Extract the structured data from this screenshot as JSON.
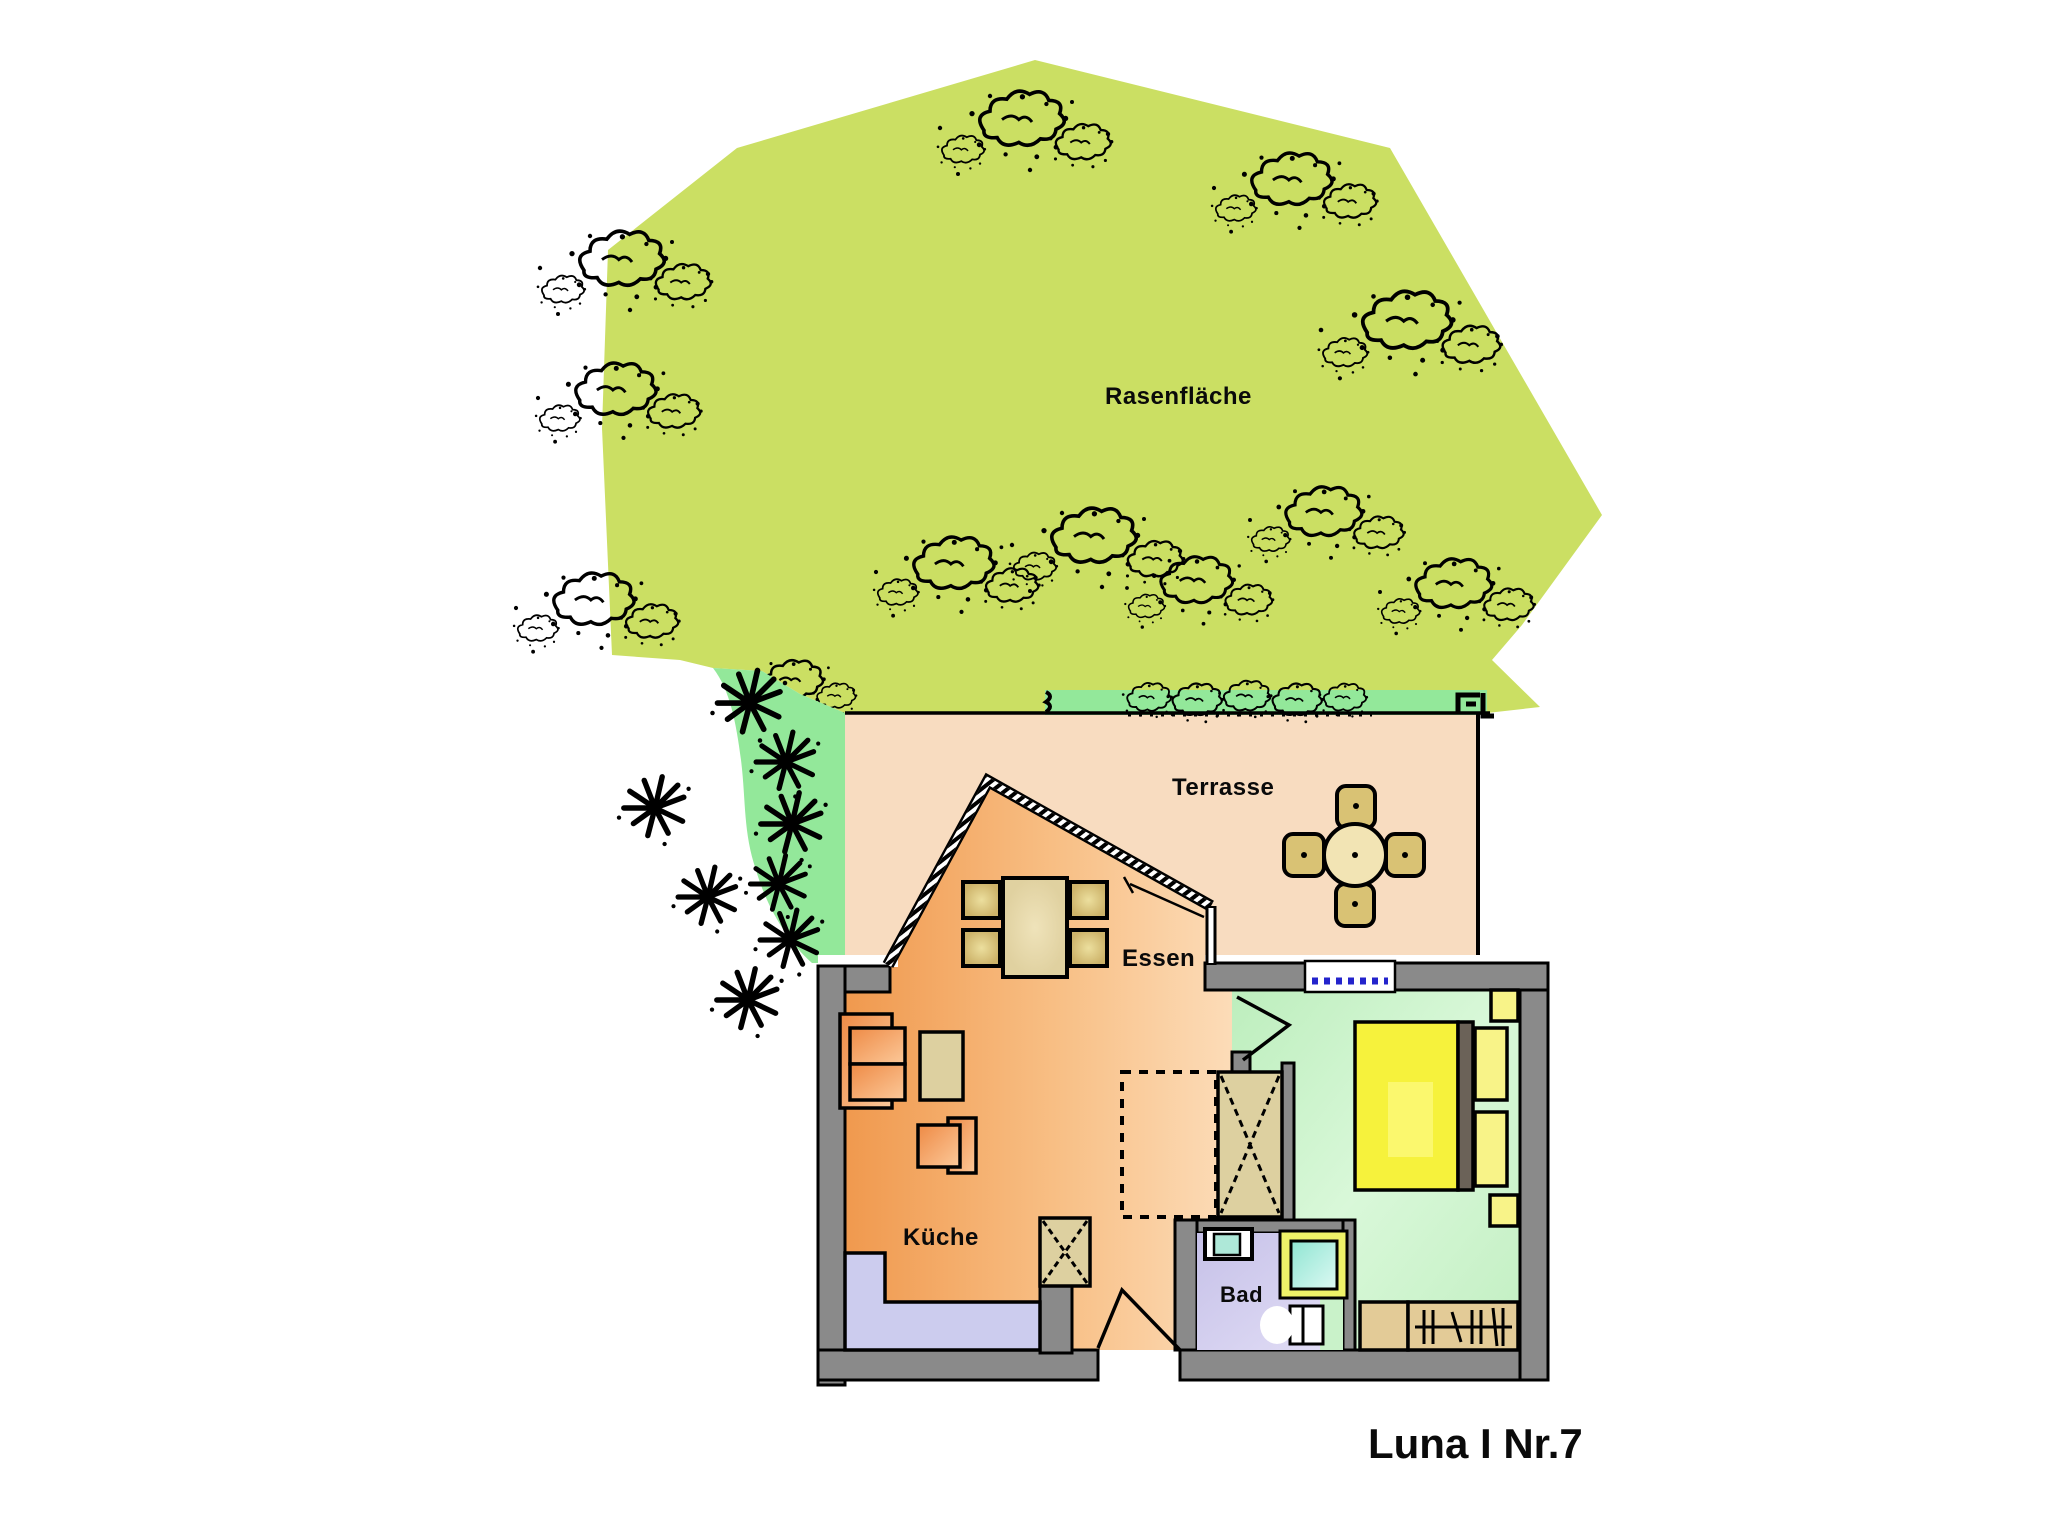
{
  "title": "Luna I Nr.7",
  "rooms": {
    "lawn_label": "Rasenfläche",
    "terrace_label": "Terrasse",
    "dining_label": "Essen",
    "kitchen_label": "Küche",
    "bath_label": "Bad"
  },
  "colors": {
    "lawn": "#cbdf63",
    "hedge_green": "#93e89a",
    "terrace": "#f8dcc0",
    "floor_orange_dark": "#f09c54",
    "floor_orange_light": "#fcd9b4",
    "bedroom_green": "#c9f2c9",
    "bath_lavender": "#cfcaec",
    "wall_gray": "#8a8a8a",
    "counter_blue": "#ccccee",
    "bed_yellow": "#f6f23c",
    "pillow_yellow": "#f8f388",
    "furniture_tan": "#ddd0a0",
    "chair_tan": "#cdb36a",
    "bench_tan": "#e3cb97",
    "window_blue": "#2323cc",
    "shower_frame": "#eef268",
    "headboard_brown": "#6b6258",
    "terrace_table_cream": "#f2e4b4",
    "terrace_chair_tan": "#d9c274"
  }
}
